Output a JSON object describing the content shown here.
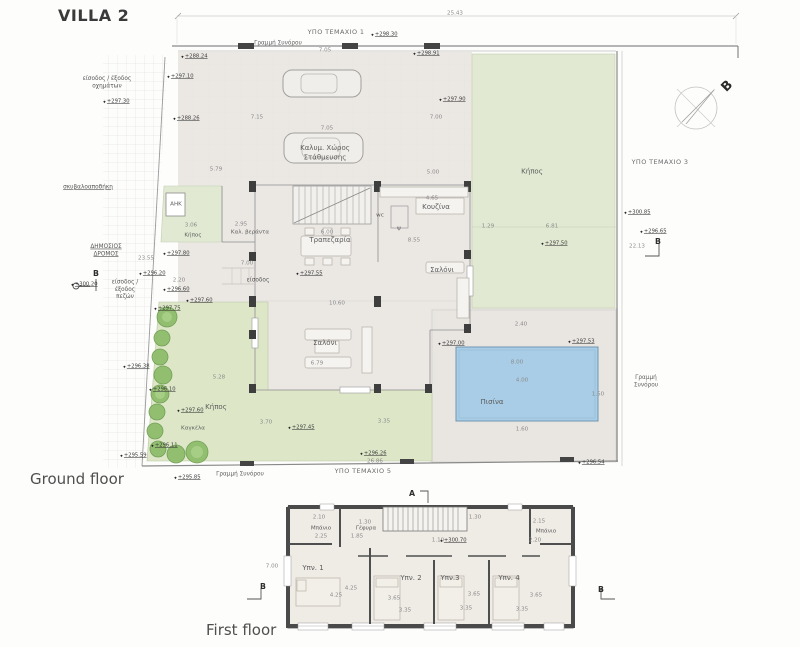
{
  "title": "VILLA 2",
  "floor_labels": {
    "ground": "Ground floor",
    "first": "First floor"
  },
  "compass": {
    "north_label": "B"
  },
  "colors": {
    "garden_green": "#dde7c8",
    "garden_green_light": "#e1e9d2",
    "pool_blue": "#a9cde6",
    "pool_border": "#6e96b2",
    "building_gray": "#ebe8e4",
    "wall_dark": "#3e3e3e",
    "tree_green": "#8cbb68",
    "line_gray": "#8a8a8a"
  },
  "annotations": [
    {
      "t": "ΥΠΟ ΤΕΜΑΧΙΟ 1",
      "x": 336,
      "y": 33,
      "c": "parcel"
    },
    {
      "t": "ΥΠΟ ΤΕΜΑΧΙΟ 3",
      "x": 660,
      "y": 163,
      "c": "parcel"
    },
    {
      "t": "ΥΠΟ ΤΕΜΑΧΙΟ 5",
      "x": 363,
      "y": 472,
      "c": "parcel"
    },
    {
      "t": "Γραμμή Συνόρου",
      "x": 278,
      "y": 44,
      "c": "bnd"
    },
    {
      "t": "Γραμμή\nΣυνόρου",
      "x": 646,
      "y": 382,
      "c": "bnd"
    },
    {
      "t": "Γραμμή Συνόρου",
      "x": 240,
      "y": 475,
      "c": "bnd"
    },
    {
      "t": "ΔΗΜΟΣΙΟΣ\nΔΡΟΜΟΣ",
      "x": 106,
      "y": 251,
      "c": "note-u"
    },
    {
      "t": "σκυβαλοαποθήκη",
      "x": 88,
      "y": 188,
      "c": "note-u"
    },
    {
      "t": "είσοδος / έξοδος\nοχημάτων",
      "x": 107,
      "y": 83,
      "c": "note"
    },
    {
      "t": "είσοδος /\nέξοδος\nπεζών",
      "x": 125,
      "y": 290,
      "c": "note"
    },
    {
      "t": "είσοδος",
      "x": 258,
      "y": 281,
      "c": "note"
    },
    {
      "t": "Καλυμ. Χώρος\nΣτάθμευσης",
      "x": 325,
      "y": 153,
      "c": "room"
    },
    {
      "t": "Κήπος",
      "x": 532,
      "y": 172,
      "c": "room"
    },
    {
      "t": "Κουζίνα",
      "x": 436,
      "y": 207,
      "c": "room"
    },
    {
      "t": "Τραπεζαρία",
      "x": 330,
      "y": 240,
      "c": "room"
    },
    {
      "t": "Σαλόνι",
      "x": 442,
      "y": 270,
      "c": "room"
    },
    {
      "t": "Σαλόνι",
      "x": 325,
      "y": 343,
      "c": "room"
    },
    {
      "t": "Πισίνα",
      "x": 492,
      "y": 402,
      "c": "room"
    },
    {
      "t": "Κήπος",
      "x": 193,
      "y": 236,
      "c": "room-s"
    },
    {
      "t": "Κήπος",
      "x": 216,
      "y": 407,
      "c": "room"
    },
    {
      "t": "Καγκέλα",
      "x": 193,
      "y": 429,
      "c": "room-s"
    },
    {
      "t": "Καλ. βεράντα",
      "x": 250,
      "y": 233,
      "c": "room-s"
    },
    {
      "t": "ΑΗΚ",
      "x": 176,
      "y": 205,
      "c": "room-s"
    },
    {
      "t": "wc",
      "x": 380,
      "y": 216,
      "c": "room-s"
    },
    {
      "t": "ψ",
      "x": 399,
      "y": 229,
      "c": "room-s"
    },
    {
      "t": "25.43",
      "x": 455,
      "y": 14,
      "c": "dim"
    },
    {
      "t": "7.05",
      "x": 325,
      "y": 51,
      "c": "dim"
    },
    {
      "t": "7.15",
      "x": 257,
      "y": 118,
      "c": "dim"
    },
    {
      "t": "7.05",
      "x": 327,
      "y": 129,
      "c": "dim"
    },
    {
      "t": "7.00",
      "x": 436,
      "y": 118,
      "c": "dim"
    },
    {
      "t": "5.79",
      "x": 216,
      "y": 170,
      "c": "dim"
    },
    {
      "t": "5.00",
      "x": 433,
      "y": 173,
      "c": "dim"
    },
    {
      "t": "3.06",
      "x": 191,
      "y": 226,
      "c": "dim"
    },
    {
      "t": "2.95",
      "x": 241,
      "y": 225,
      "c": "dim"
    },
    {
      "t": "6.00",
      "x": 327,
      "y": 233,
      "c": "dim"
    },
    {
      "t": "4.65",
      "x": 432,
      "y": 199,
      "c": "dim"
    },
    {
      "t": "8.55",
      "x": 414,
      "y": 241,
      "c": "dim"
    },
    {
      "t": "1.29",
      "x": 488,
      "y": 227,
      "c": "dim"
    },
    {
      "t": "6.81",
      "x": 552,
      "y": 227,
      "c": "dim"
    },
    {
      "t": "23.55",
      "x": 146,
      "y": 259,
      "c": "dim"
    },
    {
      "t": "2.20",
      "x": 179,
      "y": 281,
      "c": "dim"
    },
    {
      "t": "7.00",
      "x": 247,
      "y": 264,
      "c": "dim"
    },
    {
      "t": "10.60",
      "x": 337,
      "y": 304,
      "c": "dim"
    },
    {
      "t": "6.79",
      "x": 317,
      "y": 364,
      "c": "dim"
    },
    {
      "t": "5.28",
      "x": 219,
      "y": 378,
      "c": "dim"
    },
    {
      "t": "3.70",
      "x": 266,
      "y": 423,
      "c": "dim"
    },
    {
      "t": "3.35",
      "x": 384,
      "y": 422,
      "c": "dim"
    },
    {
      "t": "2.40",
      "x": 521,
      "y": 325,
      "c": "dim"
    },
    {
      "t": "8.00",
      "x": 517,
      "y": 363,
      "c": "dim"
    },
    {
      "t": "4.00",
      "x": 522,
      "y": 381,
      "c": "dim"
    },
    {
      "t": "1.50",
      "x": 598,
      "y": 395,
      "c": "dim"
    },
    {
      "t": "1.60",
      "x": 522,
      "y": 430,
      "c": "dim"
    },
    {
      "t": "26.86",
      "x": 375,
      "y": 462,
      "c": "dim"
    },
    {
      "t": "22.13",
      "x": 637,
      "y": 247,
      "c": "dim"
    },
    {
      "t": "+288.24",
      "x": 194,
      "y": 57,
      "c": "elev"
    },
    {
      "t": "+297.10",
      "x": 180,
      "y": 77,
      "c": "elev"
    },
    {
      "t": "+288.26",
      "x": 186,
      "y": 119,
      "c": "elev"
    },
    {
      "t": "+297.30",
      "x": 116,
      "y": 102,
      "c": "elev"
    },
    {
      "t": "+298.30",
      "x": 384,
      "y": 35,
      "c": "elev"
    },
    {
      "t": "+298.91",
      "x": 426,
      "y": 54,
      "c": "elev"
    },
    {
      "t": "+297.90",
      "x": 452,
      "y": 100,
      "c": "elev"
    },
    {
      "t": "+300.85",
      "x": 637,
      "y": 213,
      "c": "elev"
    },
    {
      "t": "+296.65",
      "x": 653,
      "y": 232,
      "c": "elev"
    },
    {
      "t": "+297.50",
      "x": 554,
      "y": 244,
      "c": "elev"
    },
    {
      "t": "+297.80",
      "x": 176,
      "y": 254,
      "c": "elev"
    },
    {
      "t": "+296.20",
      "x": 152,
      "y": 274,
      "c": "elev"
    },
    {
      "t": "+296.60",
      "x": 176,
      "y": 290,
      "c": "elev"
    },
    {
      "t": "+297.60",
      "x": 199,
      "y": 301,
      "c": "elev"
    },
    {
      "t": "+297.75",
      "x": 167,
      "y": 309,
      "c": "elev"
    },
    {
      "t": "+300.20",
      "x": 84,
      "y": 285,
      "c": "elev"
    },
    {
      "t": "+297.55",
      "x": 309,
      "y": 274,
      "c": "elev"
    },
    {
      "t": "+296.38",
      "x": 136,
      "y": 367,
      "c": "elev"
    },
    {
      "t": "+296.10",
      "x": 162,
      "y": 390,
      "c": "elev"
    },
    {
      "t": "+297.60",
      "x": 190,
      "y": 411,
      "c": "elev"
    },
    {
      "t": "+295.59",
      "x": 133,
      "y": 456,
      "c": "elev"
    },
    {
      "t": "+296.11",
      "x": 164,
      "y": 446,
      "c": "elev"
    },
    {
      "t": "+295.85",
      "x": 187,
      "y": 478,
      "c": "elev"
    },
    {
      "t": "+296.26",
      "x": 373,
      "y": 454,
      "c": "elev"
    },
    {
      "t": "+296.54",
      "x": 591,
      "y": 463,
      "c": "elev"
    },
    {
      "t": "+297.45",
      "x": 301,
      "y": 428,
      "c": "elev"
    },
    {
      "t": "+297.00",
      "x": 451,
      "y": 344,
      "c": "elev"
    },
    {
      "t": "+297.53",
      "x": 581,
      "y": 342,
      "c": "elev"
    },
    {
      "t": "Μπάνιο",
      "x": 321,
      "y": 529,
      "c": "room-s"
    },
    {
      "t": "Μπάνιο",
      "x": 546,
      "y": 532,
      "c": "room-s"
    },
    {
      "t": "Γέφυρα",
      "x": 366,
      "y": 529,
      "c": "room-s"
    },
    {
      "t": "Υπν. 1",
      "x": 313,
      "y": 568,
      "c": "room"
    },
    {
      "t": "Υπν. 2",
      "x": 411,
      "y": 578,
      "c": "room"
    },
    {
      "t": "Υπν.3",
      "x": 450,
      "y": 578,
      "c": "room"
    },
    {
      "t": "Υπν. 4",
      "x": 509,
      "y": 578,
      "c": "room"
    },
    {
      "t": "2.10",
      "x": 319,
      "y": 518,
      "c": "dim"
    },
    {
      "t": "2.25",
      "x": 321,
      "y": 537,
      "c": "dim"
    },
    {
      "t": "1.30",
      "x": 365,
      "y": 523,
      "c": "dim"
    },
    {
      "t": "1.85",
      "x": 357,
      "y": 537,
      "c": "dim"
    },
    {
      "t": "1.10",
      "x": 438,
      "y": 541,
      "c": "dim"
    },
    {
      "t": "1.30",
      "x": 475,
      "y": 518,
      "c": "dim"
    },
    {
      "t": "2.15",
      "x": 539,
      "y": 522,
      "c": "dim"
    },
    {
      "t": "2.20",
      "x": 535,
      "y": 541,
      "c": "dim"
    },
    {
      "t": "7.00",
      "x": 272,
      "y": 567,
      "c": "dim"
    },
    {
      "t": "4.25",
      "x": 336,
      "y": 596,
      "c": "dim"
    },
    {
      "t": "4.25",
      "x": 351,
      "y": 589,
      "c": "dim"
    },
    {
      "t": "3.65",
      "x": 394,
      "y": 599,
      "c": "dim"
    },
    {
      "t": "3.65",
      "x": 474,
      "y": 595,
      "c": "dim"
    },
    {
      "t": "3.65",
      "x": 536,
      "y": 596,
      "c": "dim"
    },
    {
      "t": "3.35",
      "x": 405,
      "y": 611,
      "c": "dim"
    },
    {
      "t": "3.35",
      "x": 466,
      "y": 609,
      "c": "dim"
    },
    {
      "t": "3.35",
      "x": 522,
      "y": 610,
      "c": "dim"
    },
    {
      "t": "+300.70",
      "x": 453,
      "y": 541,
      "c": "elev"
    },
    {
      "t": "A",
      "x": 412,
      "y": 494,
      "c": "sec"
    },
    {
      "t": "B",
      "x": 263,
      "y": 587,
      "c": "sec"
    },
    {
      "t": "B",
      "x": 601,
      "y": 590,
      "c": "sec"
    },
    {
      "t": "B",
      "x": 658,
      "y": 242,
      "c": "sec"
    },
    {
      "t": "Β",
      "x": 96,
      "y": 274,
      "c": "sec"
    },
    {
      "t": "B",
      "x": 728,
      "y": 87,
      "c": "compass-b"
    }
  ]
}
